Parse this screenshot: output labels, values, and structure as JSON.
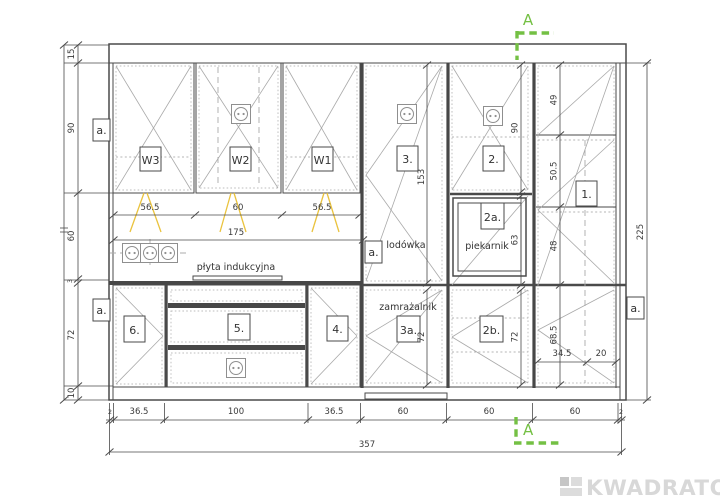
{
  "labels": {
    "w3": "W3",
    "w2": "W2",
    "w1": "W1",
    "c1": "1.",
    "c2": "2.",
    "c2a": "2a.",
    "c2b": "2b.",
    "c3": "3.",
    "c3a": "3a.",
    "c4": "4.",
    "c5": "5.",
    "c6": "6.",
    "fridge": "lodówka",
    "freezer": "zamrażalnik",
    "oven": "piekarnik",
    "hob": "płyta indukcyjna",
    "wall_marker": "a."
  },
  "dims": {
    "left": {
      "bulkhead": "15",
      "wall_cab": "90",
      "backsplash": "60",
      "worktop": "3",
      "base": "72",
      "plinth": "10"
    },
    "top": {
      "w3": "56.5",
      "w2": "60",
      "w1": "56.5",
      "run": "175"
    },
    "bottom": {
      "off_l": "2",
      "c6": "36.5",
      "c5": "100",
      "c4": "36.5",
      "col3": "60",
      "col2": "60",
      "col1": "60",
      "off_r": "2",
      "total": "357"
    },
    "right": {
      "total": "225"
    },
    "col1": {
      "d1": "49",
      "d2": "50.5",
      "d3": "48",
      "d4": "68.5",
      "w1": "34.5",
      "w2": "20"
    },
    "col2": {
      "top": "90",
      "oven": "63",
      "bottom": "72"
    },
    "col3": {
      "fridge": "153",
      "freezer": "72"
    }
  },
  "section": {
    "label": "A"
  },
  "logo": {
    "text": "KWADRATON"
  }
}
